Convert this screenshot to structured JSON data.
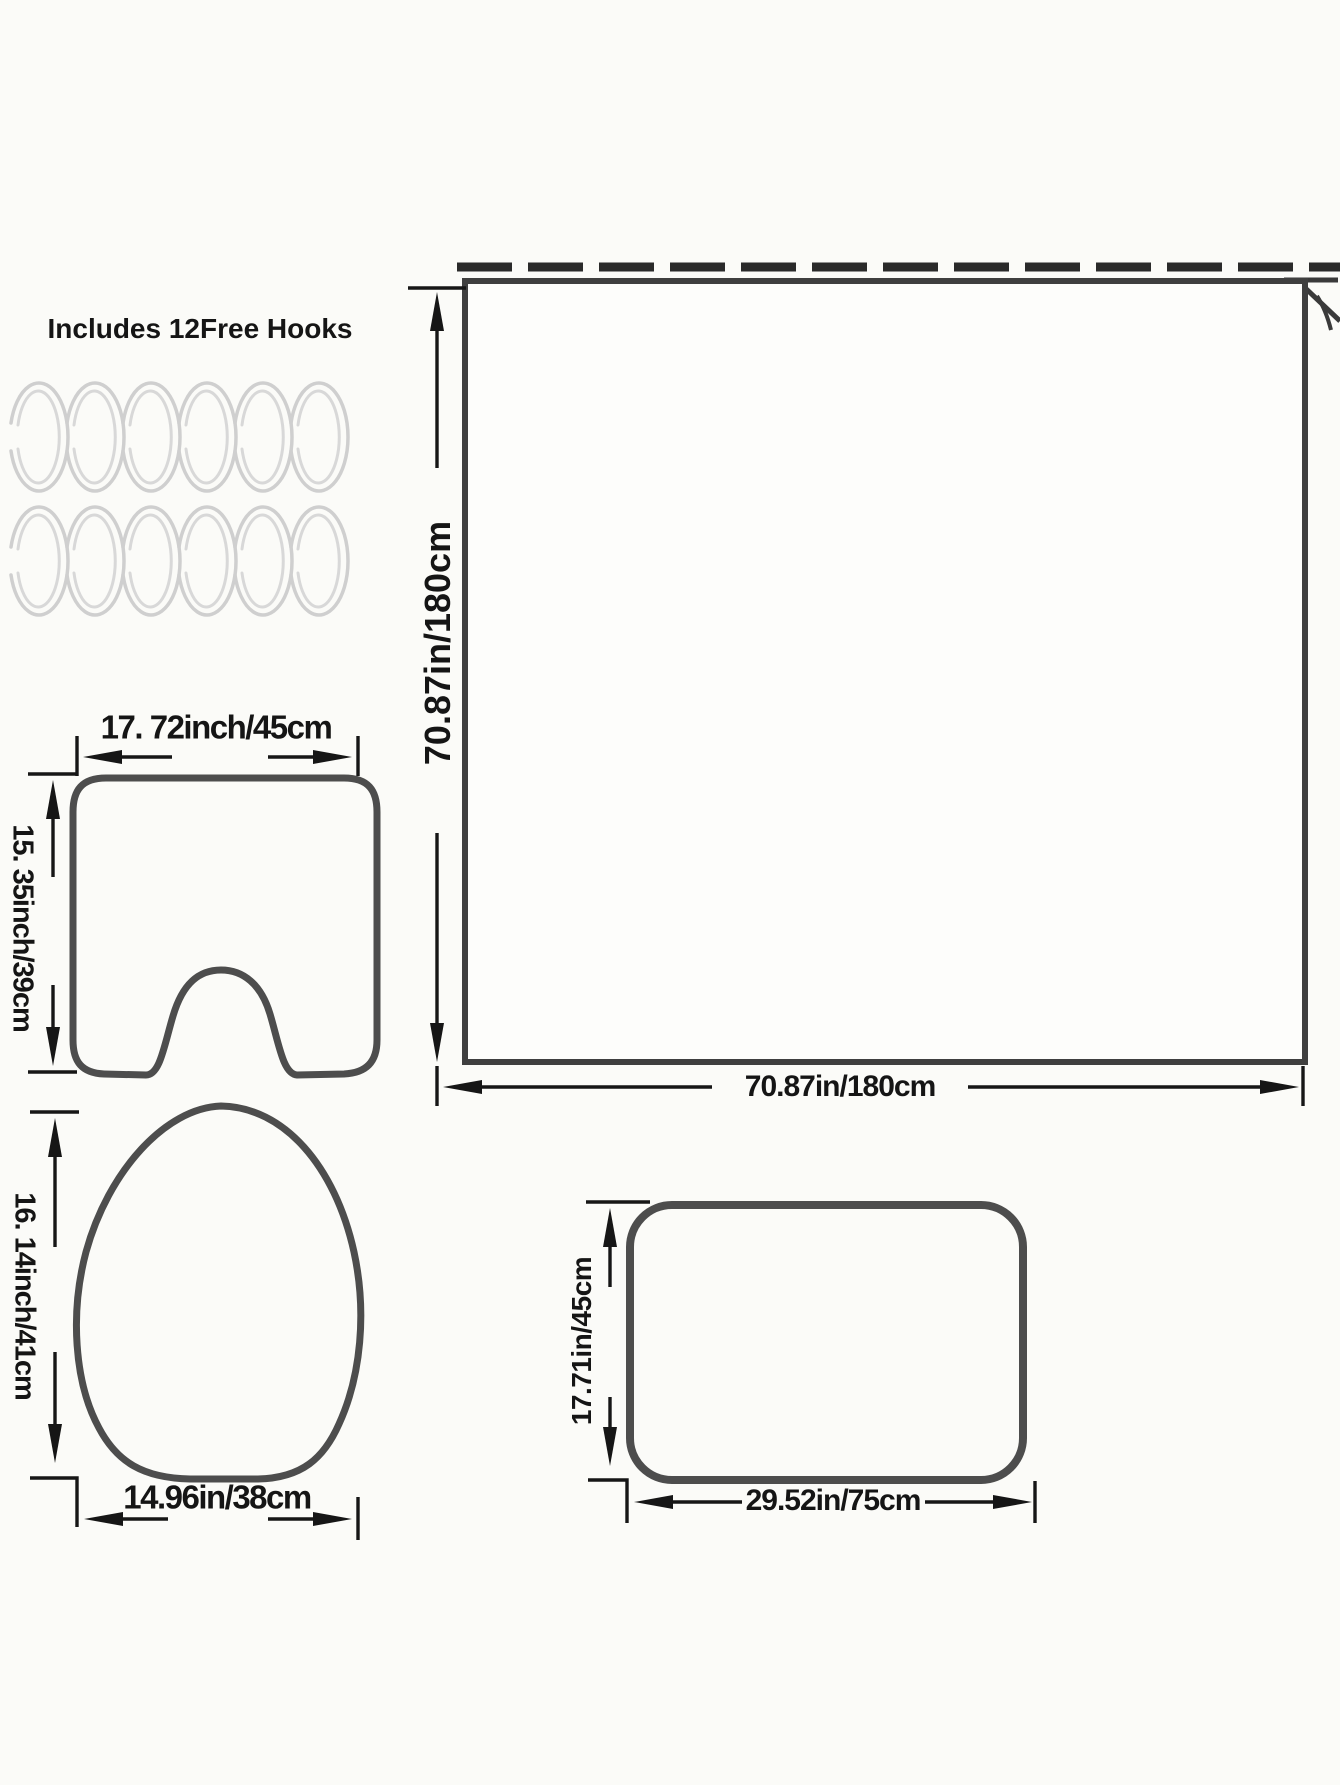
{
  "banner": {
    "title": "Includes 12Free Hooks"
  },
  "hooks": {
    "rows": 2,
    "per_row": 6,
    "total": 12
  },
  "shower_curtain": {
    "name": "shower curtain",
    "height_label": "70.87in/180cm",
    "width_label": "70.87in/180cm"
  },
  "contour_mat": {
    "name": "U-shaped contour mat",
    "width_label": "17. 72inch/45cm",
    "height_label": "15. 35inch/39cm"
  },
  "lid_cover": {
    "name": "toilet lid cover",
    "height_label": "16. 14inch/41cm",
    "width_label": "14.96in/38cm"
  },
  "bath_mat": {
    "name": "bath mat",
    "height_label": "17.71in/45cm",
    "width_label": "29.52in/75cm"
  },
  "colors": {
    "background": "#fbfbf8",
    "ink": "#151515",
    "shape_outline": "#4d4d4d",
    "rod": "#2a2a2a",
    "hook_ring": "#cfcfcf"
  }
}
